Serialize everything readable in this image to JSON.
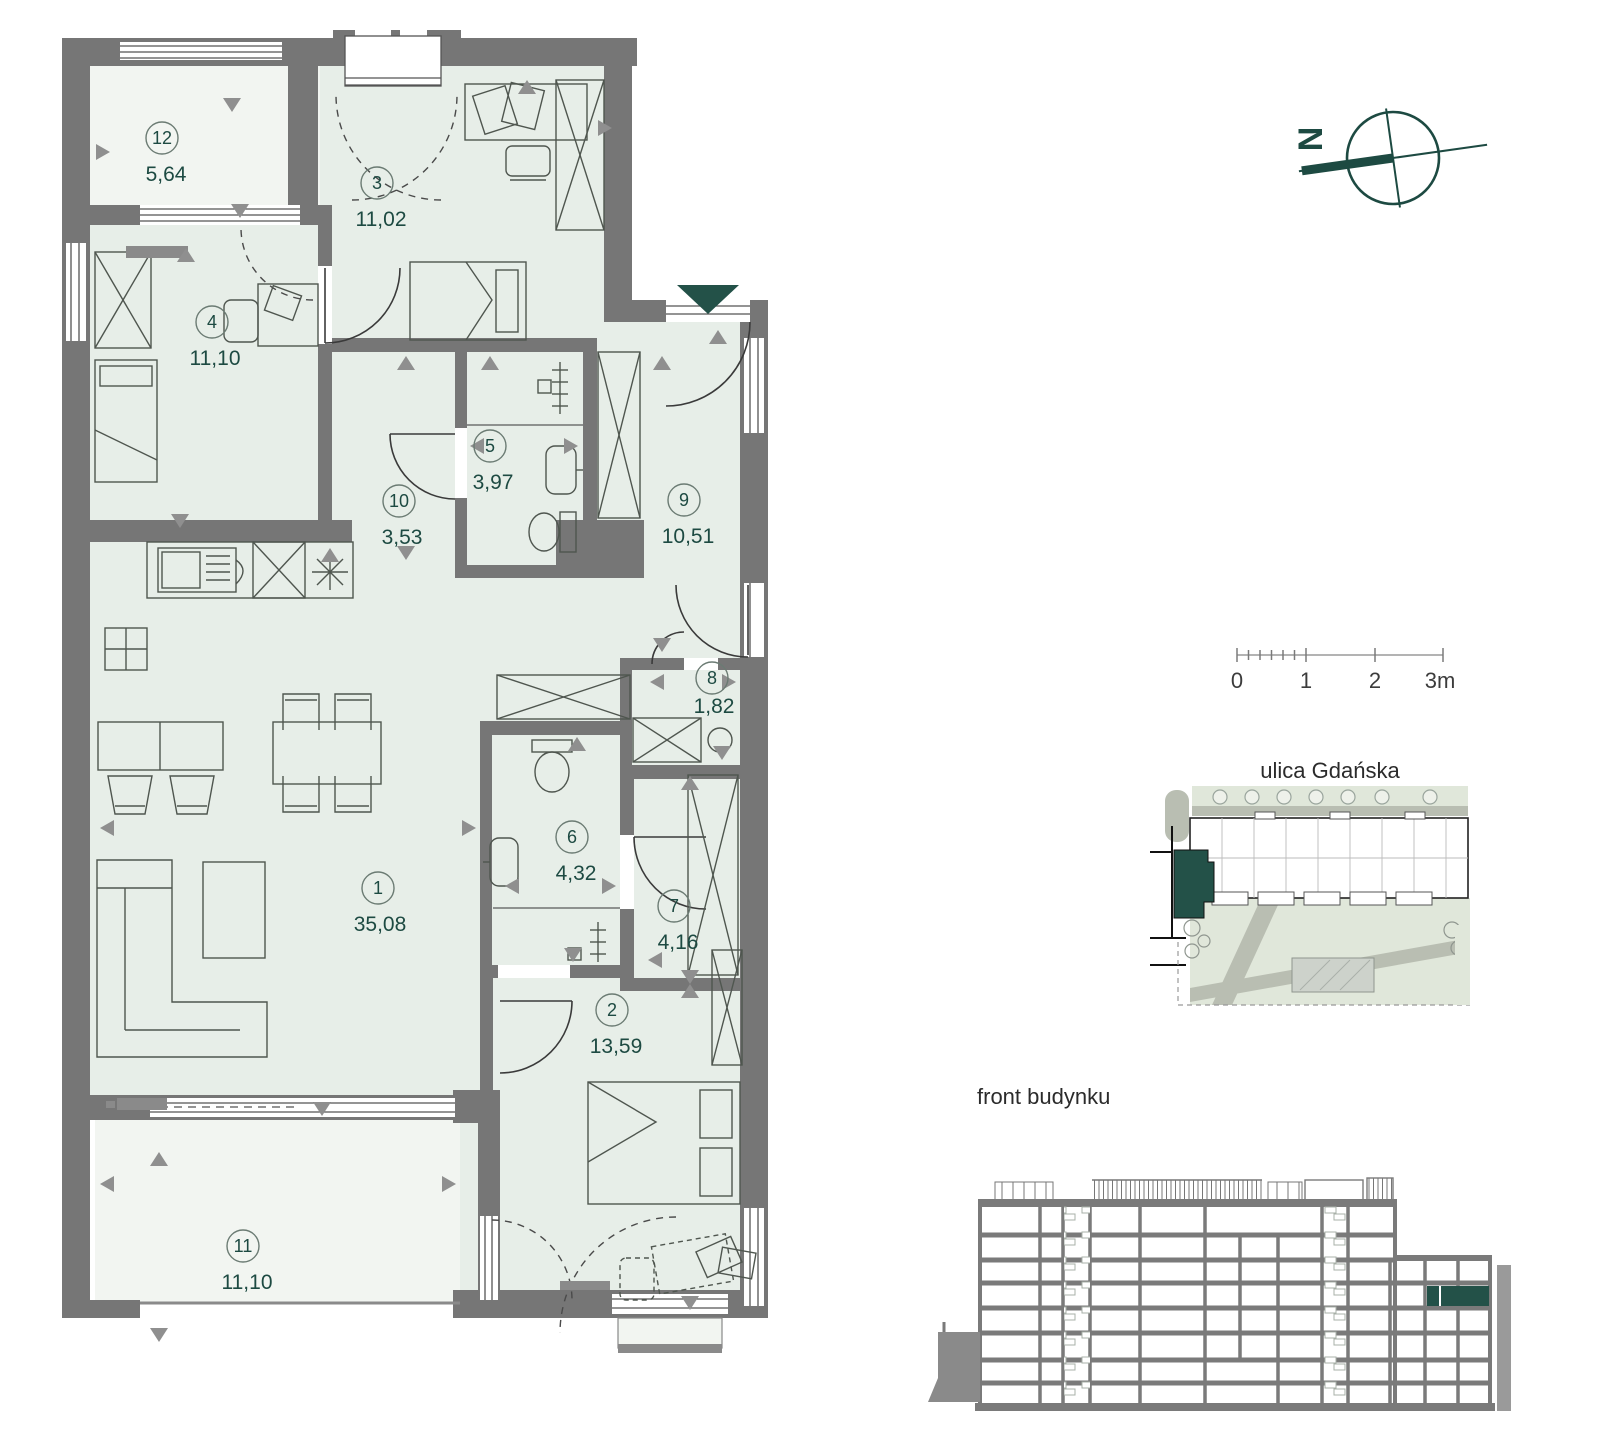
{
  "floor_plan": {
    "rooms": [
      {
        "number": "1",
        "area": "35,08"
      },
      {
        "number": "2",
        "area": "13,59"
      },
      {
        "number": "3",
        "area": "11,02"
      },
      {
        "number": "4",
        "area": "11,10"
      },
      {
        "number": "5",
        "area": "3,97"
      },
      {
        "number": "6",
        "area": "4,32"
      },
      {
        "number": "7",
        "area": "4,16"
      },
      {
        "number": "8",
        "area": "1,82"
      },
      {
        "number": "9",
        "area": "10,51"
      },
      {
        "number": "10",
        "area": "3,53"
      },
      {
        "number": "11",
        "area": "11,10"
      },
      {
        "number": "12",
        "area": "5,64"
      }
    ]
  },
  "compass": {
    "north_label": "N"
  },
  "scale_bar": {
    "labels": [
      "0",
      "1",
      "2",
      "3m"
    ]
  },
  "site_plan": {
    "street_label": "ulica Gdańska"
  },
  "elevation": {
    "label": "front budynku"
  },
  "colors": {
    "accent_teal": "#235148",
    "label_teal": "#1d4a42",
    "wall_gray": "#767676",
    "room_fill": "#e7eee8",
    "terrace_fill": "#f2f5f1"
  }
}
